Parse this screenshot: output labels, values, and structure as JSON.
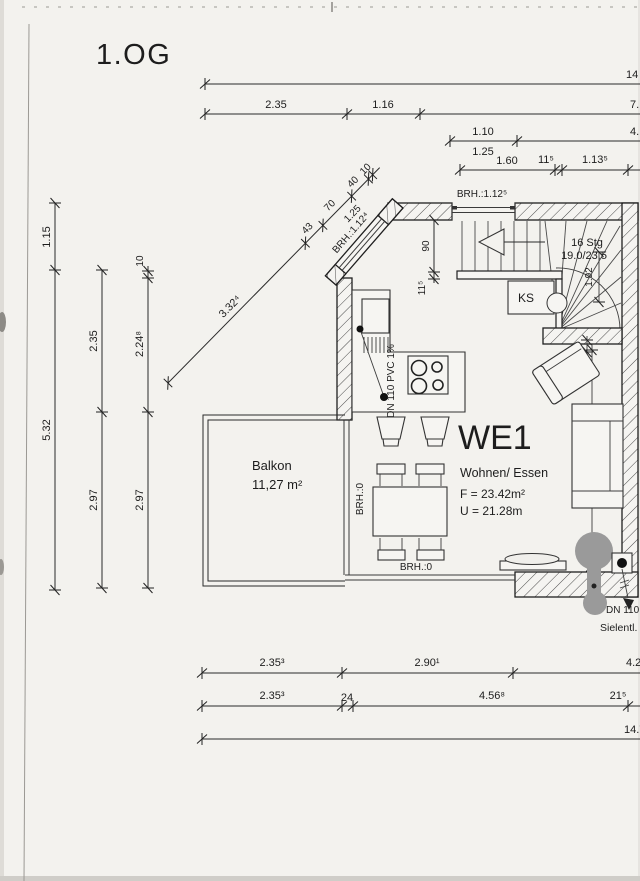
{
  "colors": {
    "paper": "#f3f2ee",
    "ink": "#2a2a2a",
    "plumbing_gray": "#9a9a9a"
  },
  "title": "1.OG",
  "room": {
    "name": "WE1",
    "use": "Wohnen/ Essen",
    "area": "F = 23.42m²",
    "perimeter": "U = 21.28m"
  },
  "balcony": {
    "name": "Balkon",
    "area": "11,27 m²"
  },
  "stairs": {
    "count": "16 Stg",
    "ratio": "19.0/23.5",
    "width": "1.92",
    "shaft": "KS"
  },
  "plumbing": {
    "pipe": "DN 110 PVC 1%",
    "drain": "DN 110",
    "vent": "Sielentl."
  },
  "sills": {
    "top": "BRH.:1.12⁵",
    "diag": "BRH.:1.12⁴",
    "left": "BRH.:0",
    "bottom": "BRH.:0"
  },
  "dims": {
    "top_total": "14",
    "top_b1": "2.35",
    "top_b2": "1.16",
    "top_b3": "7.",
    "top_c1": "1.10",
    "top_c1b": "1.25",
    "top_c2": "4.",
    "top_d1": "1.60",
    "top_d2": "11⁵",
    "top_d3": "1.13⁵",
    "diag_a": "3.32⁴",
    "diag_b": "43",
    "diag_c": "70",
    "diag_d": "40",
    "diag_e": "10",
    "diag_f": "1.25",
    "left_a1": "1.15",
    "left_a2": "5.32",
    "left_b1": "2.35",
    "left_b2": "2.97",
    "left_c0": "10",
    "left_c1": "2.24⁸",
    "left_c2": "2.97",
    "mid_a": "90",
    "mid_b": "11⁵",
    "stair_wall": "11⁸",
    "right_a": "3.95⁴",
    "bot_a1": "2.35³",
    "bot_a2": "2.90¹",
    "bot_a3": "4.2",
    "bot_b1": "2.35³",
    "bot_b2": "24",
    "bot_b3": "4.56⁸",
    "bot_b4": "21⁵",
    "bot_total": "14.7"
  }
}
